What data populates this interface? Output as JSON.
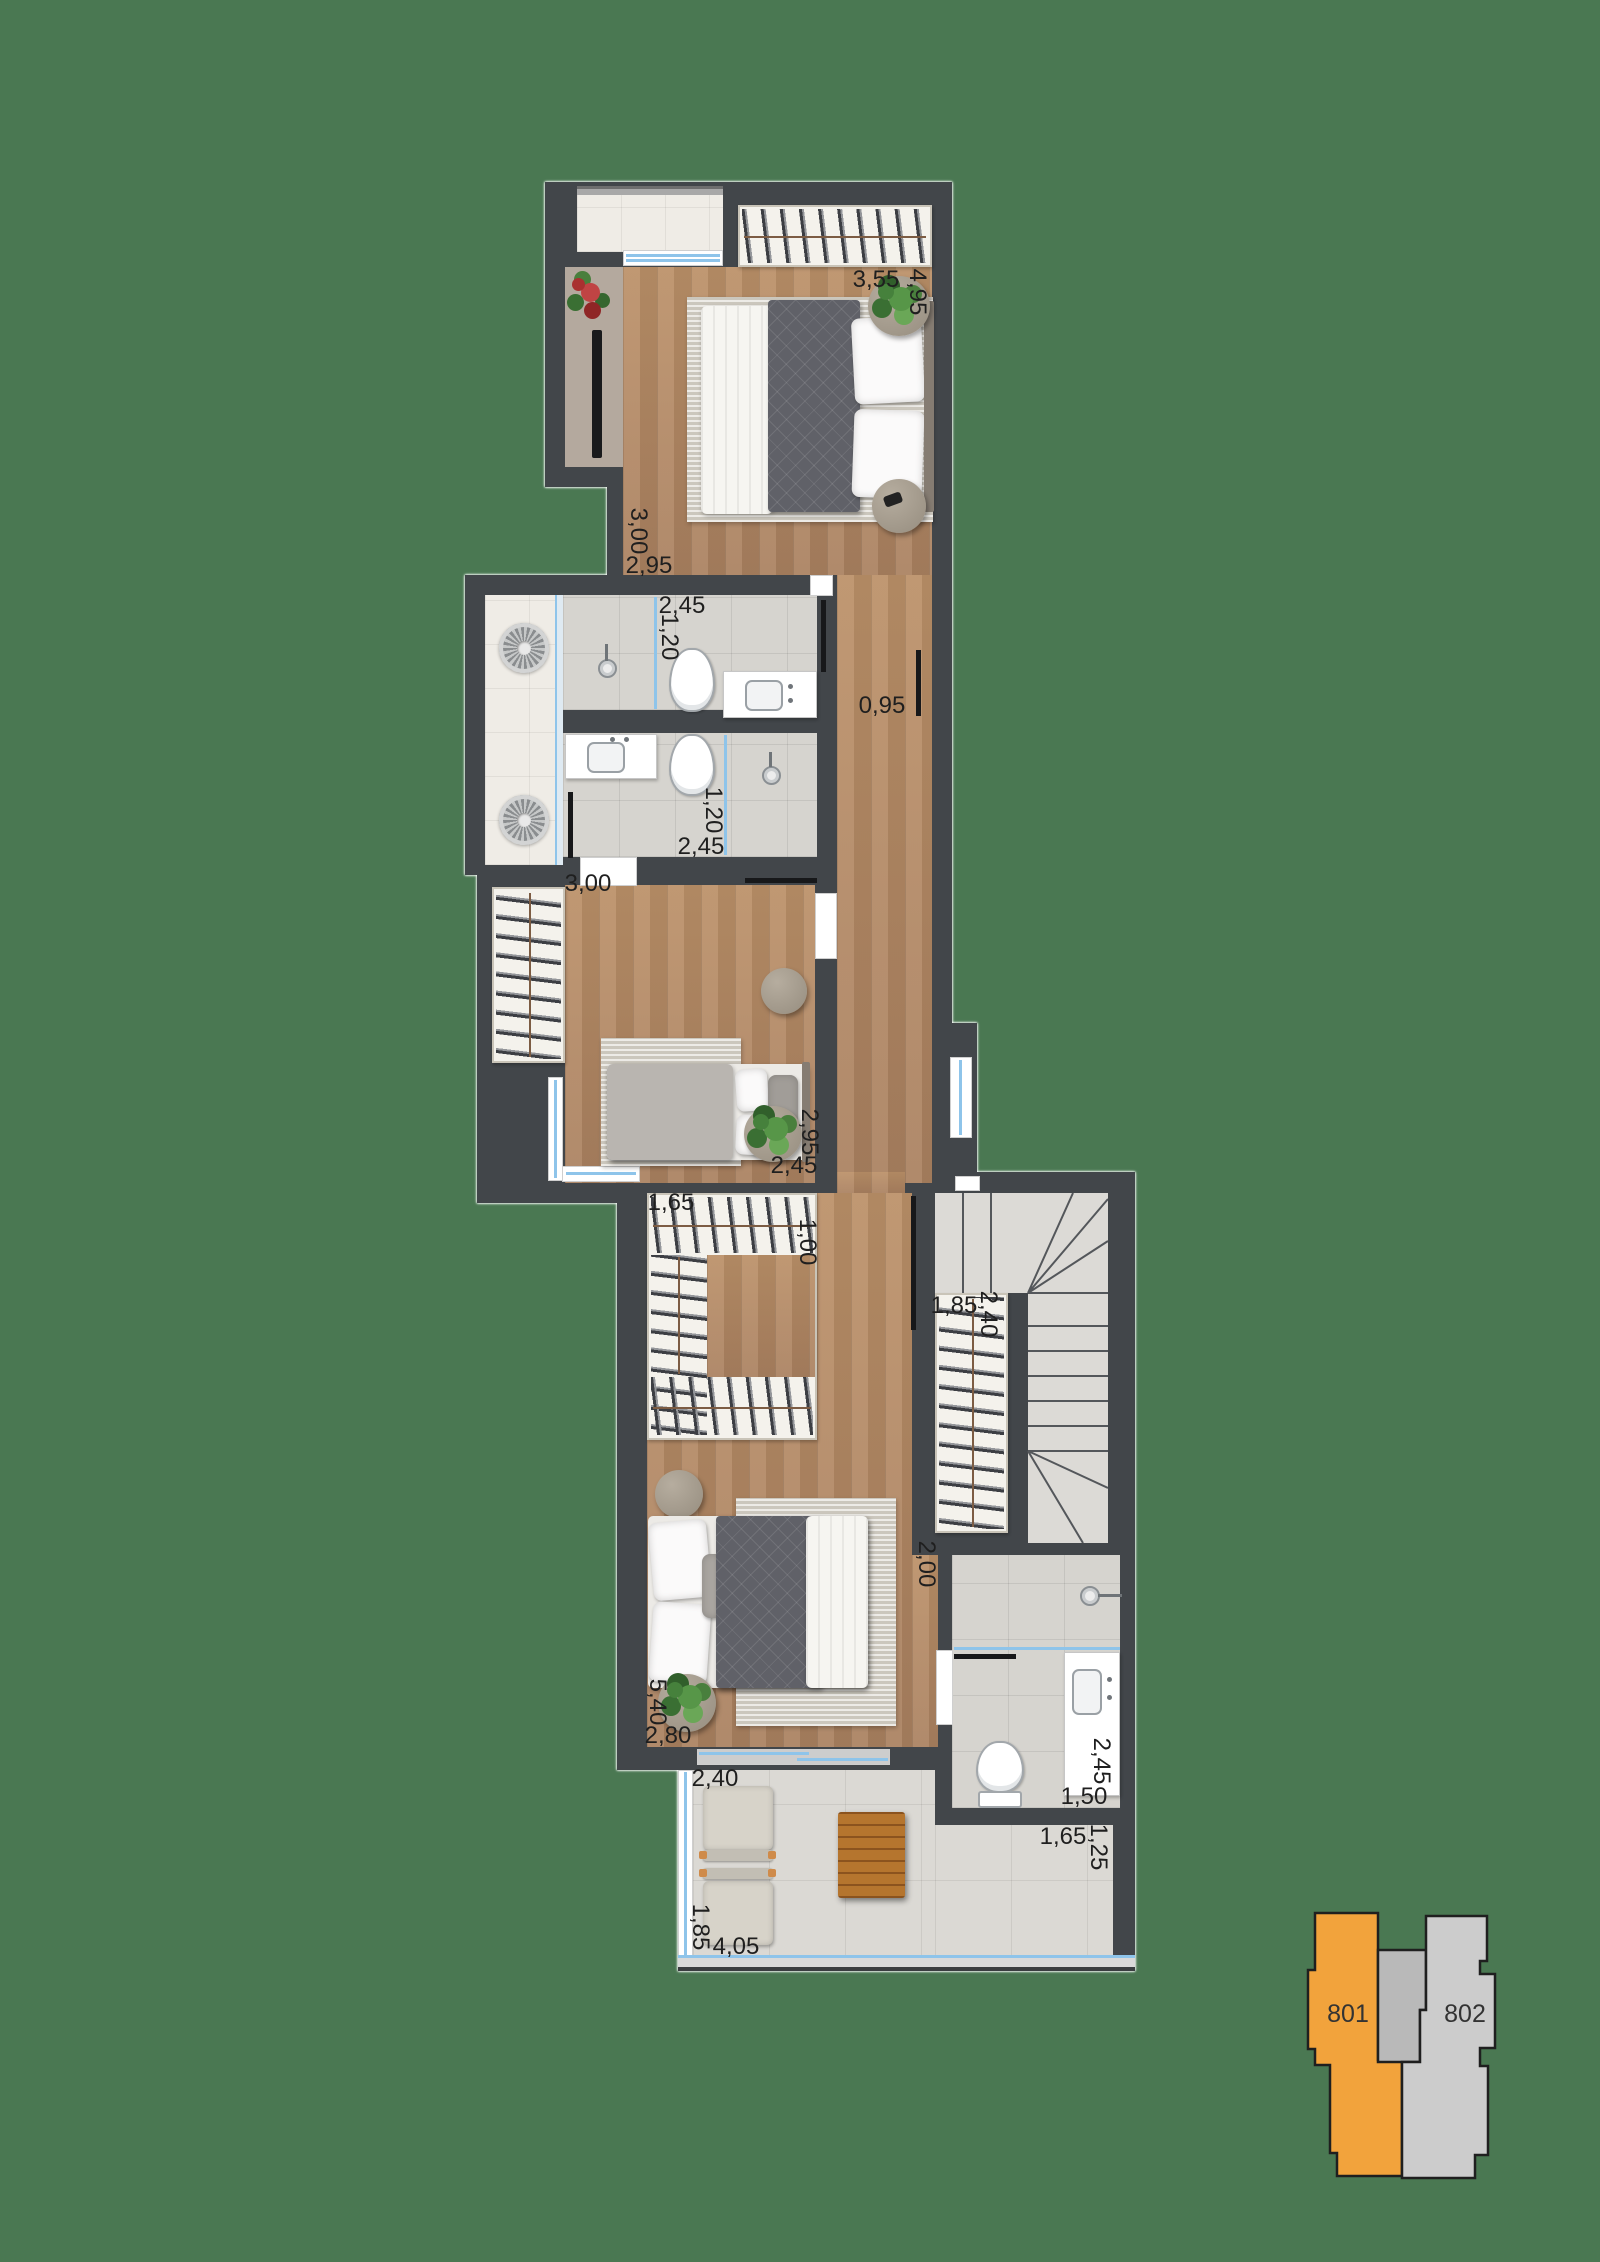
{
  "colors": {
    "background": "#4A7852",
    "unit_highlight": "#F2A33C",
    "unit_neutral": "#CCCCCC"
  },
  "dims": [
    "3,55",
    "4,95",
    "3,00",
    "2,95",
    "2,45",
    "1,20",
    "0,95",
    "1,20",
    "2,45",
    "3,00",
    "2,95",
    "2,45",
    "1,65",
    "1,00",
    "1,85",
    "2,40",
    "2,00",
    "5,40",
    "2,80",
    "2,40",
    "2,45",
    "1,50",
    "1,65",
    "1,25",
    "1,85",
    "4,05"
  ],
  "keyplan": {
    "unit1": "801",
    "unit2": "802"
  }
}
